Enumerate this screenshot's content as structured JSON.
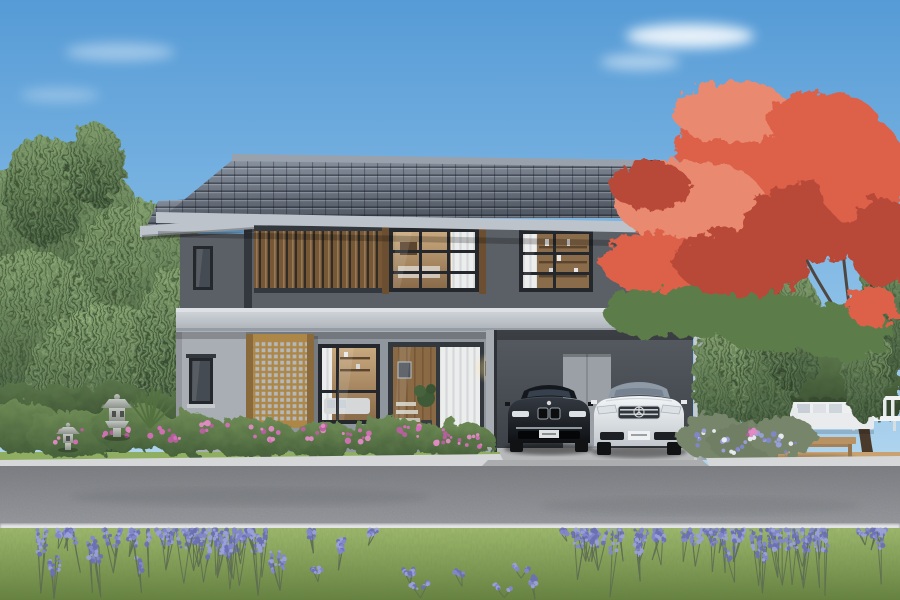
{
  "meta": {
    "title": "Modern two-storey Japanese-style house with carport, two sedans, willow and flame trees, front garden and road"
  },
  "scene": {
    "setting": "architectural exterior rendering, daytime",
    "sky": "clear blue sky with thin white clouds",
    "house": {
      "storeys": 2,
      "roof": "dark blue-grey tiled gable roof with stepped carport roof",
      "walls": "two-tone grey render",
      "accents": [
        "vertical wood slat panel",
        "wooden lattice screens",
        "warm wall lamp at entrance"
      ],
      "openings": [
        "bedroom window with white curtain",
        "shelf window",
        "living room window",
        "glass sliding entrance door",
        "carport rear door",
        "two small side windows"
      ]
    },
    "vehicles": [
      {
        "name": "black-sedan",
        "color": "black",
        "position": "carport left bay"
      },
      {
        "name": "white-sedan",
        "color": "white",
        "position": "carport right bay"
      }
    ],
    "garden": [
      "weeping willow trees",
      "flame tree with red blossoms",
      "two stone lanterns",
      "yucca plant",
      "pink flower beds",
      "lavender borders",
      "clipped hedge",
      "white garden bench",
      "white outdoor sofa",
      "wooden coffee table",
      "wooden deck"
    ],
    "foreground": [
      "lawn strip",
      "white curb",
      "asphalt road",
      "white road line",
      "meadow with purple lavender"
    ]
  },
  "palette": {
    "sky_top": "#569bd6",
    "sky_mid": "#8fc2e8",
    "sky_low": "#d3e9f6",
    "cloud": "#ffffff",
    "roof_hi": "#8d96a4",
    "roof_lo": "#525a66",
    "ridge": "#99a1ad",
    "fascia": "#bcc3ca",
    "roof_step": "#3c414a",
    "wall_upper": "#5b6067",
    "wall_lower": "#8f969d",
    "wall_wing": "#a9aeb4",
    "trim_dark": "#33383e",
    "band_hi": "#d4d9dd",
    "band_lo": "#a9afb6",
    "wood_post": "#6b4f30",
    "slat_a": "#8a6a44",
    "slat_b": "#775836",
    "slat_gap": "#322c25",
    "lattice_wood": "#ad8748",
    "lattice_dark": "#33373d",
    "lattice_cell": "#b4b8bb",
    "lattice_post": "#8a6a3a",
    "frame": "#24282d",
    "curtain_a": "#eceded",
    "curtain_b": "#d5d8da",
    "interior_hi": "#c8a97e",
    "interior_lo": "#8a6b4a",
    "shelf": "#5b452e",
    "glass_dark": "#454b52",
    "carport_hi": "#565b61",
    "carport_lo": "#3c4147",
    "cp_door": "#9aa0a6",
    "cp_floor": "#b7b8ba",
    "column_hi": "#b3bac0",
    "column_lo": "#868d94",
    "car_black_hi": "#343a42",
    "car_black_lo": "#0e1013",
    "car_white_hi": "#f4f6f7",
    "car_white_lo": "#c2c8ce",
    "chrome": "#c9ced3",
    "headlight": "#dce1e6",
    "glass_car": "#8e99a6",
    "tire": "#101214",
    "willow_hi": "#7d9a6a",
    "willow_lo": "#41583b",
    "bush_hi": "#6d8a55",
    "bush_lo": "#46603a",
    "hedge_hi": "#5a7549",
    "hedge_lo": "#35492e",
    "trunk": "#4a3a2c",
    "stem": "#5e6e52",
    "yucca": "#53713f",
    "flame": "#dd6149",
    "flame_hi": "#e98a70",
    "flame_lo": "#b84a37",
    "flame_green": "#5c7d49",
    "flower_pink": "#e08cc4",
    "flower_magenta": "#b85fa0",
    "flower_white": "#eceef4",
    "lavender1": "#8287cb",
    "lavender2": "#9aa0da",
    "lavender3": "#6b70b5",
    "stone_hi": "#c3c7c2",
    "stone_lo": "#8e928c",
    "deck": "#c9a271",
    "deck_line": "#a9845a",
    "table_wood": "#b89262",
    "sofa": "#e9ebec",
    "pillow": "#c7ced5",
    "grass_strip": "#8fae62",
    "lawn_hi": "#a2bc6f",
    "lawn_lo": "#66813f",
    "road_hi": "#9b9da1",
    "road_lo": "#7e8084",
    "road_line": "#e7e9ea",
    "curb": "#d5d7d8",
    "apron": "#abadaf",
    "lamp": "#e8d887",
    "glow": "#ffdf8e"
  }
}
